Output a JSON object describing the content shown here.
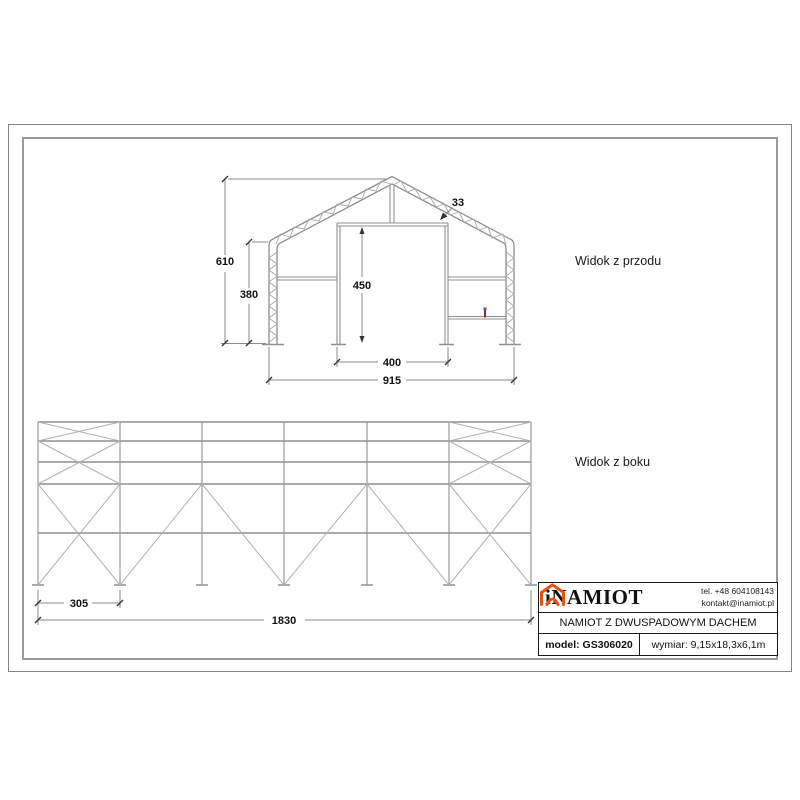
{
  "views": {
    "front": {
      "label": "Widok z przodu",
      "dims": {
        "total_height": "610",
        "wall_height": "380",
        "door_height": "450",
        "door_width": "400",
        "total_width": "915",
        "truss_depth": "33"
      }
    },
    "side": {
      "label": "Widok z boku",
      "dims": {
        "bay_width": "305",
        "total_length": "1830"
      }
    }
  },
  "title_block": {
    "brand": "iNAMIOT",
    "phone": "tel. +48 604108143",
    "email": "kontakt@inamiot.pl",
    "product_title": "NAMIOT Z DWUSPADOWYM DACHEM",
    "model": "model: GS306020",
    "dimensions": "wymiar: 9,15x18,3x6,1m",
    "accent_color": "#e8500f"
  }
}
